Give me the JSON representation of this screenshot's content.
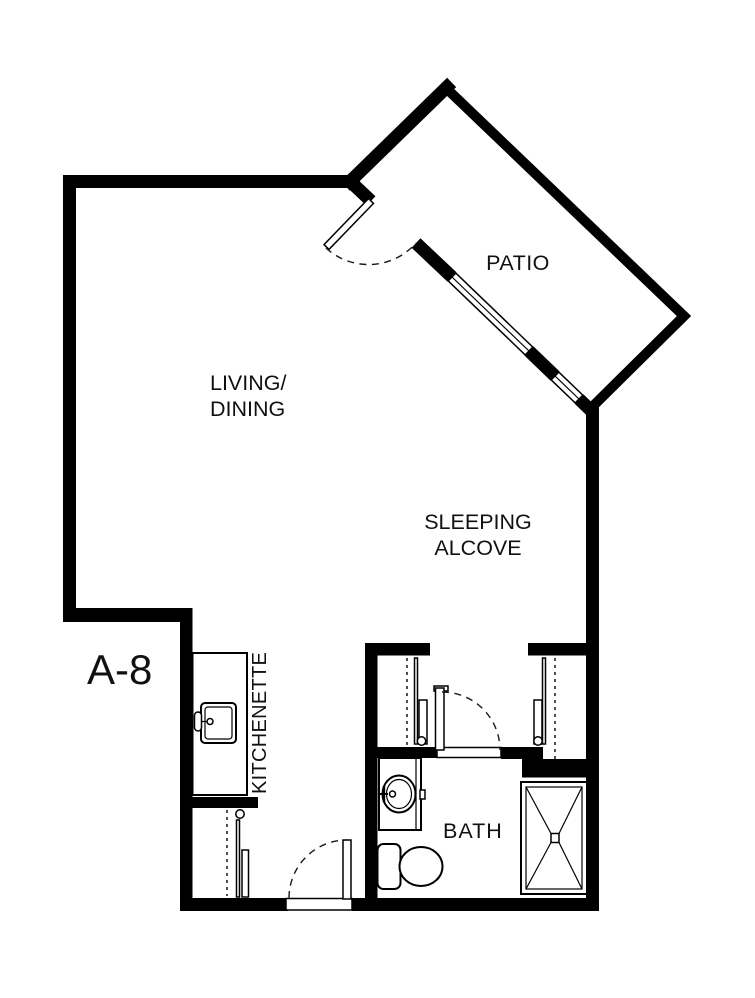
{
  "floor_plan": {
    "unit": "A-8",
    "rooms": {
      "patio": "PATIO",
      "living_line1": "LIVING/",
      "living_line2": "DINING",
      "sleeping_line1": "SLEEPING",
      "sleeping_line2": "ALCOVE",
      "kitchenette": "KITCHENETTE",
      "bath": "BATH"
    },
    "colors": {
      "wall": "#000000",
      "background": "#ffffff",
      "text": "#111111"
    },
    "doors": [
      "patio-door",
      "bath-door",
      "entry-door"
    ],
    "windows": [
      "patio-window-1",
      "patio-window-2"
    ],
    "fixtures": [
      "kitchen-sink",
      "bath-sink",
      "vanity",
      "toilet",
      "shower",
      "closet-rod"
    ]
  }
}
